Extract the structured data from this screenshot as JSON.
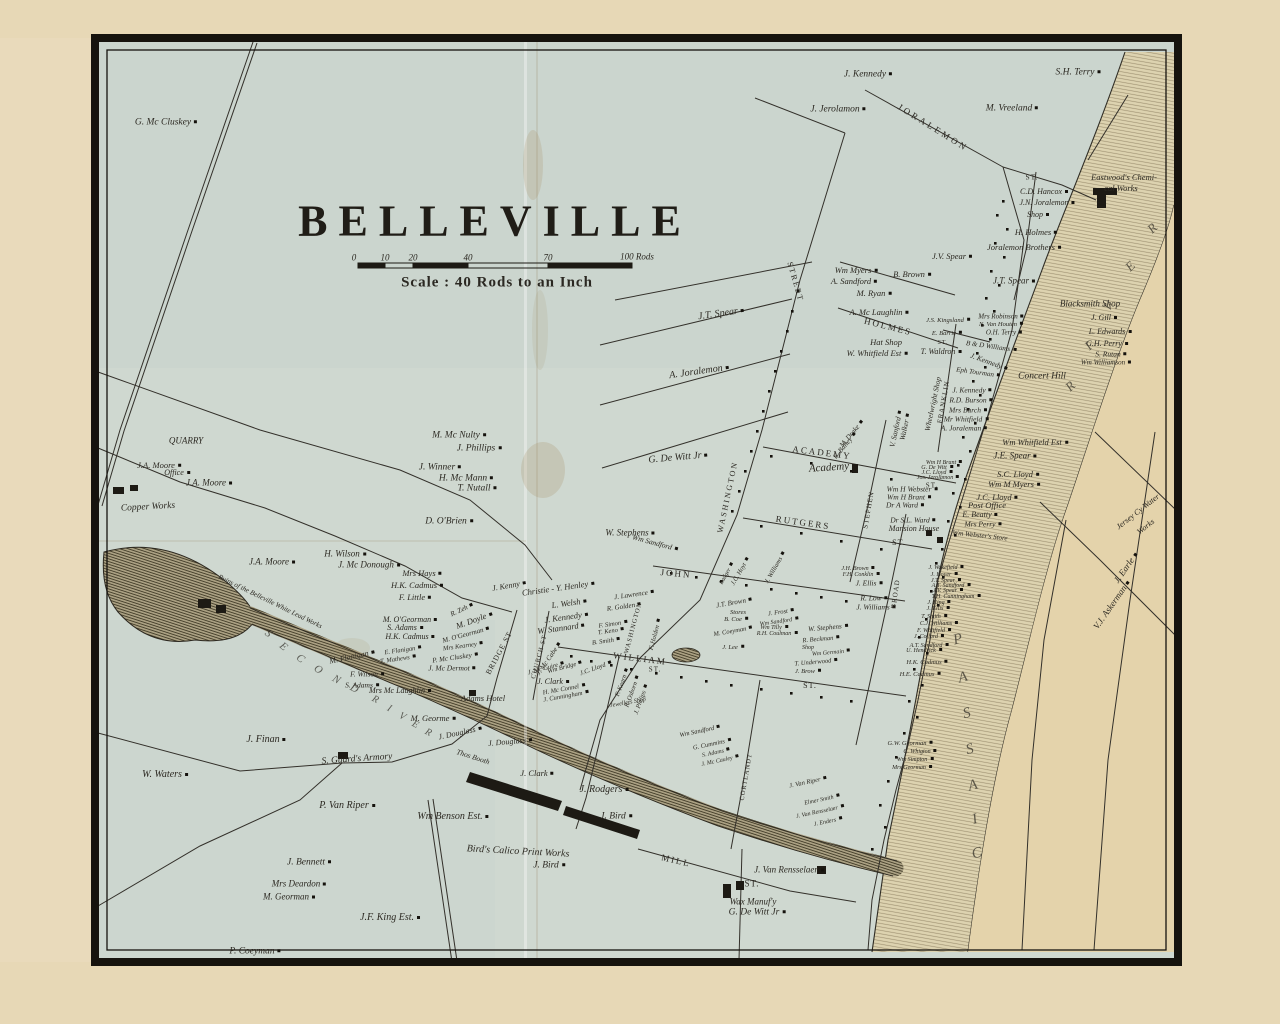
{
  "map": {
    "title": "BELLEVILLE",
    "scale_caption": "Scale : 40 Rods to an Inch"
  },
  "colors": {
    "paper_tan": "#e7d8b6",
    "sheet": "#cfd8d0",
    "east_bank": "#e4d3ab",
    "ink": "#2c2922",
    "frame": "#16130e"
  },
  "scale_ticks": [
    [
      354,
      258,
      "0",
      9
    ],
    [
      385,
      258,
      "10",
      9
    ],
    [
      413,
      258,
      "20",
      9
    ],
    [
      468,
      258,
      "40",
      9
    ],
    [
      548,
      258,
      "70",
      9
    ],
    [
      637,
      257,
      "100 Rods",
      9
    ]
  ],
  "streets": [
    [
      933,
      128,
      "JORALEMON",
      9,
      32,
      3
    ],
    [
      795,
      282,
      "STREET",
      8,
      74,
      2
    ],
    [
      888,
      327,
      "HOLMES",
      9,
      14,
      2
    ],
    [
      822,
      453,
      "ACADEMY",
      9,
      7,
      2
    ],
    [
      803,
      523,
      "RUTGERS",
      9,
      8,
      2
    ],
    [
      676,
      574,
      "JOHN",
      9,
      5,
      2
    ],
    [
      640,
      659,
      "WILLIAM",
      9,
      7,
      2
    ],
    [
      676,
      861,
      "MILL",
      9,
      13,
      2
    ],
    [
      728,
      497,
      "WASHINGTON",
      8,
      -78,
      2
    ],
    [
      634,
      628,
      "WASHINGTON",
      6.5,
      -75,
      1
    ],
    [
      944,
      402,
      "FRANKLIN",
      7,
      -80,
      1
    ],
    [
      869,
      510,
      "STEPHEN",
      7,
      -80,
      1
    ],
    [
      896,
      594,
      "BROAD",
      7,
      -82,
      1
    ],
    [
      499,
      653,
      "BRIDGE ST",
      7.5,
      -62,
      1
    ],
    [
      540,
      657,
      "CHURCH ST",
      6.5,
      -75,
      1
    ],
    [
      747,
      777,
      "CORTLANDT",
      6.5,
      -80,
      1
    ],
    [
      1032,
      177,
      "ST.",
      7.5,
      0,
      1
    ],
    [
      932,
      486,
      "ST.",
      7,
      0,
      1
    ],
    [
      899,
      543,
      "ST.",
      8,
      0,
      1
    ],
    [
      943,
      343,
      "ST.",
      6,
      0,
      1
    ],
    [
      810,
      686,
      "ST.",
      8,
      0,
      1
    ],
    [
      655,
      670,
      "ST.",
      7,
      0,
      1
    ],
    [
      752,
      884,
      "ST.",
      9,
      0,
      1
    ]
  ],
  "places": [
    [
      1124,
      177,
      "Eastwood's Chemi-",
      8.5,
      0
    ],
    [
      1121,
      188,
      "cal Works",
      8.5,
      0
    ],
    [
      1090,
      304,
      "Blacksmith Shop",
      9,
      0
    ],
    [
      1042,
      377,
      "Concert Hill",
      9.5,
      0
    ],
    [
      886,
      342,
      "Hat Shop",
      8.5,
      0
    ],
    [
      933,
      404,
      "Wheelwright Shop",
      7.5,
      -78
    ],
    [
      987,
      505,
      "Post Office",
      8.5,
      0
    ],
    [
      914,
      529,
      "Mansion House",
      8,
      0
    ],
    [
      980,
      536,
      "Wm Webster's Store",
      7,
      6
    ],
    [
      829,
      468,
      "Academy",
      11,
      -4
    ],
    [
      186,
      441,
      "QUARRY",
      9,
      0
    ],
    [
      148,
      508,
      "Copper Works",
      9.5,
      -3
    ],
    [
      270,
      602,
      "Ruins of the Belleville White Lead Works",
      7,
      26
    ],
    [
      357,
      760,
      "S. Guard's Armory",
      9.5,
      -4
    ],
    [
      473,
      757,
      "Thos Booth",
      7.5,
      18
    ],
    [
      518,
      852,
      "Bird's Calico Print Works",
      10,
      3
    ],
    [
      753,
      902,
      "Wax Manuf'y",
      9,
      0
    ],
    [
      483,
      698,
      "Adams Hotel",
      8.5,
      0
    ],
    [
      628,
      703,
      "Jewellers Shop",
      6,
      -10
    ],
    [
      738,
      613,
      "Stores",
      6.5,
      0
    ],
    [
      808,
      648,
      "Shop",
      6,
      0
    ],
    [
      1138,
      512,
      "Jersey Cy Water",
      8,
      -38
    ],
    [
      1146,
      527,
      "Works",
      8,
      -38
    ]
  ],
  "letters": [
    [
      268,
      634,
      "S",
      11,
      40
    ],
    [
      283,
      647,
      "E",
      11,
      40
    ],
    [
      300,
      659,
      "C",
      11,
      38
    ],
    [
      318,
      670,
      "O",
      11,
      34
    ],
    [
      336,
      680,
      "N",
      11,
      30
    ],
    [
      354,
      689,
      "D",
      11,
      28
    ],
    [
      375,
      700,
      "R",
      10,
      28
    ],
    [
      389,
      709,
      "I",
      10,
      28
    ],
    [
      402,
      717,
      "V",
      10,
      28
    ],
    [
      415,
      725,
      "E",
      10,
      28
    ],
    [
      428,
      733,
      "R",
      10,
      28
    ],
    [
      1152,
      228,
      "R",
      13,
      -45
    ],
    [
      1130,
      266,
      "E",
      13,
      -45
    ],
    [
      1108,
      306,
      "V",
      13,
      -45
    ],
    [
      1088,
      346,
      "I",
      13,
      -45
    ],
    [
      1070,
      386,
      "R",
      13,
      -45
    ],
    [
      958,
      640,
      "P",
      15,
      -15
    ],
    [
      963,
      678,
      "A",
      15,
      -15
    ],
    [
      967,
      714,
      "S",
      15,
      -15
    ],
    [
      970,
      750,
      "S",
      15,
      -15
    ],
    [
      973,
      786,
      "A",
      15,
      -15
    ],
    [
      975,
      820,
      "I",
      15,
      -15
    ],
    [
      977,
      854,
      "C",
      15,
      -15
    ]
  ],
  "names": [
    [
      868,
      75,
      "J. Kennedy",
      9.5,
      0
    ],
    [
      1078,
      73,
      "S.H. Terry",
      9.5,
      0
    ],
    [
      838,
      110,
      "J. Jerolamon",
      9.5,
      0
    ],
    [
      1012,
      109,
      "M. Vreeland",
      9.5,
      0
    ],
    [
      166,
      123,
      "G. Mc Cluskey",
      9.5,
      0
    ],
    [
      952,
      256,
      "J.V. Spear",
      8.5,
      0
    ],
    [
      1044,
      192,
      "C.D. Hancox",
      8,
      0
    ],
    [
      1047,
      203,
      "J.N. Joralemon",
      8,
      0
    ],
    [
      1038,
      215,
      "Shop",
      8,
      0
    ],
    [
      1036,
      232,
      "H. Holmes",
      8.5,
      0
    ],
    [
      1024,
      247,
      "Joralemon Brothers",
      8.5,
      0
    ],
    [
      1014,
      281,
      "J.T. Spear",
      9,
      0
    ],
    [
      1104,
      318,
      "J. Gill",
      8,
      0
    ],
    [
      1110,
      332,
      "L. Edwards",
      8,
      0
    ],
    [
      1107,
      344,
      "G.H. Perry",
      8,
      0
    ],
    [
      1111,
      354,
      "S. Rutan",
      7.5,
      0
    ],
    [
      1106,
      363,
      "Wm Williamson",
      7,
      0
    ],
    [
      856,
      270,
      "Wm Myers",
      8.5,
      0
    ],
    [
      912,
      274,
      "B. Brown",
      8.5,
      0
    ],
    [
      854,
      281,
      "A. Sandford",
      8.5,
      0
    ],
    [
      874,
      293,
      "M. Ryan",
      8.5,
      0
    ],
    [
      879,
      312,
      "A. Mc Laughlin",
      8.5,
      0
    ],
    [
      948,
      321,
      "J.S. Kingsland",
      6.5,
      0
    ],
    [
      947,
      334,
      "E. Barrie",
      6.5,
      0
    ],
    [
      877,
      353,
      "W. Whitfield Est",
      8.5,
      0
    ],
    [
      941,
      352,
      "T. Waldron",
      8,
      0
    ],
    [
      1001,
      317,
      "Mrs Robinson",
      7,
      0
    ],
    [
      1001,
      325,
      "N. Van Houten",
      6.5,
      0
    ],
    [
      1004,
      333,
      "O.H. Terry",
      7,
      0
    ],
    [
      991,
      347,
      "B & D Williams",
      7,
      8
    ],
    [
      989,
      362,
      "J. Kennedy",
      7.5,
      20
    ],
    [
      978,
      373,
      "Eph Tourman",
      7,
      8
    ],
    [
      972,
      390,
      "J. Kennedy",
      7.5,
      0
    ],
    [
      971,
      400,
      "R.D. Burson",
      7.5,
      0
    ],
    [
      968,
      410,
      "Mrs Burch",
      7.5,
      0
    ],
    [
      966,
      419,
      "Mr Whitfield",
      7.5,
      0
    ],
    [
      964,
      428,
      "A. Joraleman",
      7.5,
      0
    ],
    [
      905,
      427,
      "Walker",
      7.5,
      -78
    ],
    [
      896,
      429,
      "V. Sanford",
      7.5,
      -78
    ],
    [
      852,
      434,
      "M. Drake",
      7,
      -50
    ],
    [
      845,
      446,
      "E. Bailey",
      7,
      -50
    ],
    [
      1035,
      442,
      "Wm Whitfield Est",
      8.5,
      0
    ],
    [
      1015,
      456,
      "J.E. Spear",
      9,
      0
    ],
    [
      1018,
      474,
      "S.C. Lloyd",
      8.5,
      0
    ],
    [
      1014,
      484,
      "Wm M Myers",
      8.5,
      0
    ],
    [
      997,
      497,
      "J.C. Lloyd",
      8.5,
      0
    ],
    [
      980,
      515,
      "E. Beatty",
      8,
      0
    ],
    [
      983,
      524,
      "Mrs Perry",
      7.5,
      0
    ],
    [
      944,
      463,
      "Wm H Brant",
      6,
      0
    ],
    [
      937,
      468,
      "G. De Witt",
      6,
      0
    ],
    [
      937,
      473,
      "J.C. Lloyd",
      6,
      0
    ],
    [
      938,
      478,
      "Jos. Jerolamon",
      6,
      0
    ],
    [
      912,
      489,
      "Wm H Webster",
      7.5,
      0
    ],
    [
      909,
      497,
      "Wm H Brant",
      7.5,
      0
    ],
    [
      905,
      505,
      "Dr A Ward",
      7.5,
      0
    ],
    [
      913,
      520,
      "Dr S.L. Ward",
      7.5,
      0
    ],
    [
      721,
      314,
      "J.T. Spear",
      10,
      -8
    ],
    [
      699,
      372,
      "A. Joralemon",
      10,
      -8
    ],
    [
      678,
      458,
      "G. De Witt Jr",
      10,
      -5
    ],
    [
      630,
      533,
      "W. Stephens",
      9,
      0
    ],
    [
      655,
      543,
      "Wm Sandford",
      7.5,
      15
    ],
    [
      459,
      436,
      "M. Mc Nulty",
      9.5,
      0
    ],
    [
      479,
      449,
      "J. Phillips",
      9.5,
      0
    ],
    [
      440,
      468,
      "J. Winner",
      9.5,
      0
    ],
    [
      466,
      479,
      "H. Mc Mann",
      9.5,
      0
    ],
    [
      477,
      489,
      "T. Nutall",
      9.5,
      0
    ],
    [
      449,
      522,
      "D. O'Brien",
      9.5,
      0
    ],
    [
      159,
      465,
      "J.A. Moore",
      8.5,
      0
    ],
    [
      177,
      473,
      "Office",
      8,
      0
    ],
    [
      209,
      483,
      "J.A. Moore",
      9,
      0
    ],
    [
      272,
      562,
      "J.A. Moore",
      9,
      0
    ],
    [
      345,
      554,
      "H. Wilson",
      9,
      0
    ],
    [
      369,
      565,
      "J. Mc Donough",
      9,
      0
    ],
    [
      422,
      573,
      "Mrs Hays",
      8.5,
      0
    ],
    [
      417,
      585,
      "H.K. Cadmus",
      8.5,
      0
    ],
    [
      415,
      597,
      "F. Little",
      8.5,
      0
    ],
    [
      410,
      620,
      "M. O'Georman",
      8,
      0
    ],
    [
      405,
      628,
      "S. Adams",
      8,
      0
    ],
    [
      410,
      637,
      "H.K. Cadmus",
      8,
      0
    ],
    [
      462,
      610,
      "R. Zeh",
      7,
      -25
    ],
    [
      474,
      620,
      "M. Doyle",
      8.5,
      -20
    ],
    [
      466,
      635,
      "M. O'Georman",
      7,
      -15
    ],
    [
      352,
      657,
      "M. Flanigan",
      8,
      -12
    ],
    [
      403,
      651,
      "E. Flanigan",
      6.5,
      -8
    ],
    [
      463,
      647,
      "Mrs Kearney",
      6.5,
      -8
    ],
    [
      398,
      660,
      "T. Mathews",
      6.5,
      -8
    ],
    [
      455,
      658,
      "P. Mc Cluskey",
      7,
      -8
    ],
    [
      367,
      674,
      "F. Wilson",
      7.5,
      0
    ],
    [
      362,
      685,
      "S. Adams",
      7.5,
      0
    ],
    [
      400,
      691,
      "Mrs Mc Laughlin",
      8,
      0
    ],
    [
      452,
      668,
      "J. Mc Dermot",
      7.5,
      0
    ],
    [
      433,
      718,
      "M. Georme",
      8.5,
      0
    ],
    [
      460,
      733,
      "J. Douglass",
      8,
      -12
    ],
    [
      510,
      742,
      "J. Douglass",
      8,
      -5
    ],
    [
      537,
      773,
      "J. Clark",
      8.5,
      0
    ],
    [
      604,
      790,
      "J. Rodgers",
      10,
      0
    ],
    [
      616,
      817,
      "J. Bird",
      9.5,
      0
    ],
    [
      453,
      817,
      "Wm Benson Est.",
      10,
      0
    ],
    [
      549,
      866,
      "J. Bird",
      9.5,
      0
    ],
    [
      266,
      740,
      "J. Finan",
      10,
      0
    ],
    [
      165,
      775,
      "W. Waters",
      10,
      0
    ],
    [
      347,
      806,
      "P. Van Riper",
      10,
      0
    ],
    [
      309,
      863,
      "J. Bennett",
      9.5,
      0
    ],
    [
      299,
      884,
      "Mrs Deardon",
      9,
      0
    ],
    [
      289,
      897,
      "M. Georman",
      9,
      0
    ],
    [
      390,
      918,
      "J.F. King Est.",
      10,
      0
    ],
    [
      255,
      952,
      "P. Coeyman",
      9.5,
      0
    ],
    [
      789,
      870,
      "J. Van Rensselaer",
      9,
      0
    ],
    [
      757,
      913,
      "G. De Witt Jr",
      9.5,
      0
    ],
    [
      509,
      586,
      "J. Kenny",
      8,
      -10
    ],
    [
      558,
      588,
      "Christie - Y. Henley",
      8.5,
      -8
    ],
    [
      569,
      603,
      "L. Welsh",
      8.5,
      -8
    ],
    [
      566,
      617,
      "J. Kennedy",
      8.5,
      -8
    ],
    [
      561,
      628,
      "W. Stannard",
      8.5,
      -8
    ],
    [
      634,
      595,
      "J. Lawrence",
      7,
      -8
    ],
    [
      624,
      607,
      "R. Golden",
      7,
      -8
    ],
    [
      613,
      625,
      "F. Simon",
      6.5,
      -8
    ],
    [
      611,
      632,
      "T. Keno",
      6.5,
      -8
    ],
    [
      606,
      642,
      "B. Smith",
      6.5,
      -8
    ],
    [
      656,
      635,
      "F. Holden",
      6.5,
      -75
    ],
    [
      549,
      659,
      "J. Mc Cabe",
      7,
      -55
    ],
    [
      546,
      669,
      "J. Mc Guire",
      6.5,
      -15
    ],
    [
      565,
      668,
      "Wm Bridge",
      6.5,
      -15
    ],
    [
      553,
      682,
      "J. Clark",
      8,
      0
    ],
    [
      564,
      690,
      "H. Mc Connel",
      6.5,
      -10
    ],
    [
      566,
      697,
      "J. Cunningham",
      6.5,
      -10
    ],
    [
      596,
      669,
      "J.C. Lloyd",
      6.5,
      -20
    ],
    [
      623,
      683,
      "F. Kearn",
      6.5,
      -70
    ],
    [
      633,
      692,
      "R. Osborn",
      6.5,
      -70
    ],
    [
      642,
      700,
      "J. Philips",
      6.5,
      -70
    ],
    [
      741,
      572,
      "J.C. Hoyt",
      6.5,
      -60
    ],
    [
      727,
      574,
      "Badger",
      6,
      -60
    ],
    [
      776,
      568,
      "J. Williams",
      6.5,
      -60
    ],
    [
      734,
      603,
      "J.T. Brown",
      7,
      -10
    ],
    [
      736,
      620,
      "B. Coe",
      6.5,
      0
    ],
    [
      733,
      632,
      "M. Coeyman",
      6.5,
      -10
    ],
    [
      733,
      648,
      "J. Lee",
      6.5,
      0
    ],
    [
      781,
      613,
      "J. Frost",
      6.5,
      -8
    ],
    [
      779,
      622,
      "Wm Sandford",
      6,
      -8
    ],
    [
      774,
      628,
      "Wm Tilly",
      6,
      0
    ],
    [
      777,
      634,
      "R.H. Coulman",
      6,
      0
    ],
    [
      828,
      628,
      "W. Stephens",
      7,
      -5
    ],
    [
      821,
      640,
      "R. Beckman",
      6.5,
      -5
    ],
    [
      831,
      653,
      "Wm Germain",
      6,
      -5
    ],
    [
      816,
      663,
      "T. Underwood",
      6.5,
      -5
    ],
    [
      808,
      672,
      "J. Brow",
      6.5,
      0
    ],
    [
      869,
      583,
      "J. Ellis",
      7.5,
      0
    ],
    [
      874,
      598,
      "R. Low",
      7.5,
      0
    ],
    [
      876,
      607,
      "J. Williams",
      7.5,
      0
    ],
    [
      861,
      575,
      "F.H. Conklin",
      6,
      0
    ],
    [
      858,
      569,
      "J.H. Brown",
      6,
      0
    ],
    [
      946,
      568,
      "J. Wakefield",
      6,
      0
    ],
    [
      944,
      575,
      "J. Hoyer",
      6,
      0
    ],
    [
      946,
      581,
      "J.T. Spear",
      6,
      0
    ],
    [
      951,
      586,
      "A.T. Sandford",
      6,
      0
    ],
    [
      948,
      591,
      "J.V. Spear",
      6,
      0
    ],
    [
      956,
      597,
      "T.H. Cunningham",
      6,
      0
    ],
    [
      939,
      603,
      "J. King",
      6,
      0
    ],
    [
      938,
      609,
      "J. Ellis",
      6,
      0
    ],
    [
      934,
      617,
      "T. Smith",
      6,
      0
    ],
    [
      939,
      624,
      "C.J. Williams",
      6,
      0
    ],
    [
      934,
      631,
      "F. Whitfield",
      6,
      0
    ],
    [
      929,
      637,
      "J. Collard",
      6,
      0
    ],
    [
      929,
      646,
      "A.T. Sandford",
      6,
      0
    ],
    [
      924,
      651,
      "U. Hendrick",
      6,
      0
    ],
    [
      927,
      663,
      "H.K. Cadmus",
      6.5,
      0
    ],
    [
      920,
      675,
      "H.E. Cadmus",
      6.5,
      0
    ],
    [
      700,
      732,
      "Wm Sandford",
      6.5,
      -12
    ],
    [
      712,
      745,
      "G. Cummins",
      6.5,
      -12
    ],
    [
      716,
      753,
      "S. Adams",
      6,
      -12
    ],
    [
      720,
      761,
      "J. Mc Cauley",
      6,
      -12
    ],
    [
      808,
      783,
      "J. Van Riper",
      6.5,
      -12
    ],
    [
      822,
      800,
      "Elmer Smith",
      6,
      -12
    ],
    [
      820,
      812,
      "J. Van Rensselaer",
      6,
      -12
    ],
    [
      828,
      822,
      "J. Enders",
      6,
      -12
    ],
    [
      910,
      744,
      "G.W. Georman",
      6.5,
      0
    ],
    [
      920,
      752,
      "C. Whigton",
      6,
      0
    ],
    [
      915,
      760,
      "Wm Simpton",
      6,
      0
    ],
    [
      912,
      768,
      "Mrs Georman",
      6,
      0
    ],
    [
      1126,
      568,
      "J. Earle",
      9,
      -55
    ],
    [
      1112,
      605,
      "V.J. Askerman",
      9,
      -55
    ]
  ]
}
